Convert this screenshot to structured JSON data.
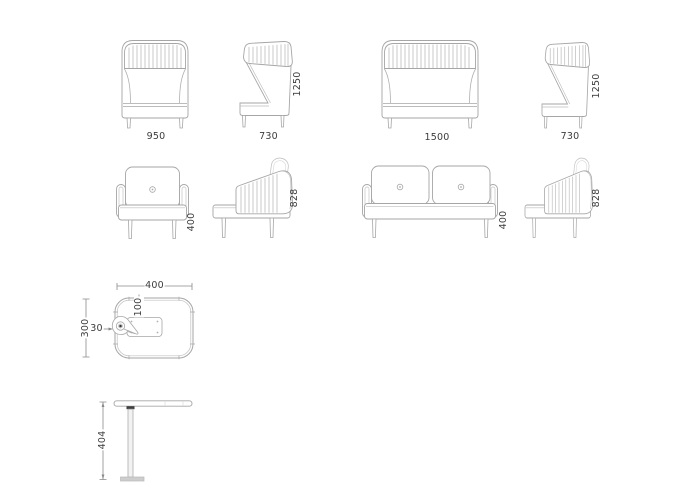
{
  "drawing": {
    "type": "furniture-dimension-drawing",
    "colors": {
      "line": "#a6a6a6",
      "stripe": "#b4b4b4",
      "dim_text": "#3c3c3c",
      "dim_line": "#8a8a8a"
    }
  },
  "views": {
    "hb_armchair_front": {
      "width": "950"
    },
    "hb_armchair_side": {
      "depth": "730",
      "height": "1250"
    },
    "hb_sofa_front": {
      "width": "1500"
    },
    "hb_sofa_side": {
      "depth": "730",
      "height": "1250"
    },
    "lb_armchair_front": {
      "seat_height": "400"
    },
    "lb_armchair_side": {
      "back_height": "828"
    },
    "lb_sofa_front": {
      "seat_height": "400"
    },
    "lb_sofa_side": {
      "back_height": "828"
    },
    "table_top": {
      "width": "400",
      "depth": "300",
      "rim": "30",
      "inset": "100"
    },
    "table_side": {
      "height": "404"
    }
  }
}
